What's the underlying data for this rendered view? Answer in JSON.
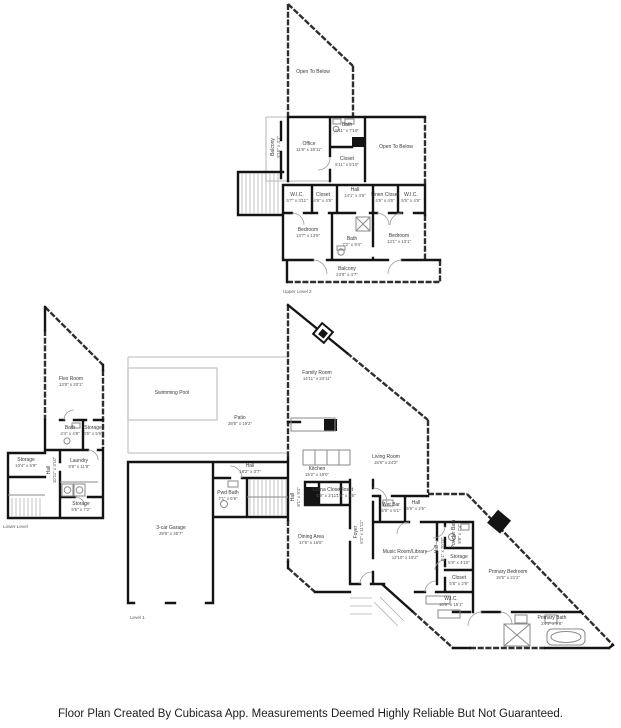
{
  "footer": {
    "text": "Floor Plan Created By Cubicasa App. Measurements Deemed Highly Reliable But Not Guaranteed."
  },
  "colors": {
    "wall": "#141414",
    "light_wall": "#c6c6c6",
    "fixture": "#8a8a8a",
    "background": "#ffffff"
  },
  "plans": {
    "upper": {
      "caption": "Upper Level 2",
      "rooms": {
        "open_below_left": {
          "name": "Open To Below",
          "dims": ""
        },
        "balcony_side": {
          "name": "Balcony",
          "dims": "9'10\" x 3'1\""
        },
        "office": {
          "name": "Office",
          "dims": "11'8\" x 19'11\""
        },
        "bath_top": {
          "name": "Bath",
          "dims": "5'11\" x 7'10\""
        },
        "open_below_right": {
          "name": "Open To Below",
          "dims": ""
        },
        "closet_top": {
          "name": "Closet",
          "dims": "5'11\" x 5'10\""
        },
        "wic_left": {
          "name": "W.I.C.",
          "dims": "5'7\" x 3'11\""
        },
        "closet_left": {
          "name": "Closet",
          "dims": "4'8\" x 4'6\""
        },
        "hall": {
          "name": "Hall",
          "dims": "14'1\" x 4'6\""
        },
        "linen_closet": {
          "name": "Linen Closet",
          "dims": "4'6\" x 4'6\""
        },
        "wic_right": {
          "name": "W.I.C.",
          "dims": "5'5\" x 4'6\""
        },
        "bedroom_left": {
          "name": "Bedroom",
          "dims": "13'7\" x 13'5\""
        },
        "bath_mid": {
          "name": "Bath",
          "dims": "7'2\" x 9'4\""
        },
        "bedroom_right": {
          "name": "Bedroom",
          "dims": "13'1\" x 13'1\""
        },
        "balcony": {
          "name": "Balcony",
          "dims": "23'8\" x 4'7\""
        }
      }
    },
    "lower": {
      "caption": "Lower Level",
      "rooms": {
        "flex_room": {
          "name": "Flex Room",
          "dims": "13'8\" x 20'1\""
        },
        "bath": {
          "name": "Bath",
          "dims": "4'4\" x 4'8\""
        },
        "storage_1": {
          "name": "Storage",
          "dims": "4'6\" x 5'6\""
        },
        "storage_2": {
          "name": "Storage",
          "dims": "10'4\" x 5'9\""
        },
        "hall": {
          "name": "Hall",
          "dims": "10'11\" x 3'10\""
        },
        "laundry": {
          "name": "Laundry",
          "dims": "9'9\" x 11'8\""
        },
        "storage_3": {
          "name": "Storage",
          "dims": "9'5\" x 7'2\""
        }
      }
    },
    "main": {
      "caption": "Level 1",
      "rooms": {
        "swimming_pool": {
          "name": "Swimming Pool",
          "dims": ""
        },
        "patio": {
          "name": "Patio",
          "dims": "28'8\" x 19'2\""
        },
        "family_room": {
          "name": "Family Room",
          "dims": "14'11\" x 24'11\""
        },
        "kitchen": {
          "name": "Kitchen",
          "dims": "15'2\" x 19'0\""
        },
        "living_room": {
          "name": "Living Room",
          "dims": "18'6\" x 24'2\""
        },
        "hall_top": {
          "name": "Hall",
          "dims": "18'2\" x 3'7\""
        },
        "pwd_bath": {
          "name": "Pwd Bath",
          "dims": "7'1\" x 6'9\""
        },
        "hall_stairs": {
          "name": "Hall",
          "dims": "8'1\" x 9'4\""
        },
        "china_closet": {
          "name": "China Closet",
          "dims": "5'8\" x 2'11\""
        },
        "closet_kitchen": {
          "name": "Closet",
          "dims": "1'8\" x 2'5\""
        },
        "garage": {
          "name": "3-car Garage",
          "dims": "29'8\" x 35'7\""
        },
        "dining_area": {
          "name": "Dining Area",
          "dims": "17'6\" x 16'6\""
        },
        "wet_bar": {
          "name": "Wet Bar",
          "dims": "5'9\" x 5'1\""
        },
        "hall_wetbar": {
          "name": "Hall",
          "dims": "5'6\" x 2'5\""
        },
        "foyer": {
          "name": "Foyer",
          "dims": "6'2\" x 11'11\""
        },
        "music_room": {
          "name": "Music Room/Library",
          "dims": "12'10\" x 19'2\""
        },
        "hall_long": {
          "name": "Hall",
          "dims": "8'1\" x 20'10\""
        },
        "powder_bath": {
          "name": "Powder Bath",
          "dims": "5'8\" x 7'4\""
        },
        "storage": {
          "name": "Storage",
          "dims": "5'8\" x 4'10\""
        },
        "closet": {
          "name": "Closet",
          "dims": "5'8\" x 2'9\""
        },
        "wic": {
          "name": "W.I.C.",
          "dims": "10'6\" x 15'1\""
        },
        "primary_bedroom": {
          "name": "Primary Bedroom",
          "dims": "19'5\" x 21'2\""
        },
        "primary_bath": {
          "name": "Primary Bath",
          "dims": "24'1\" x 9'8\""
        }
      }
    }
  }
}
